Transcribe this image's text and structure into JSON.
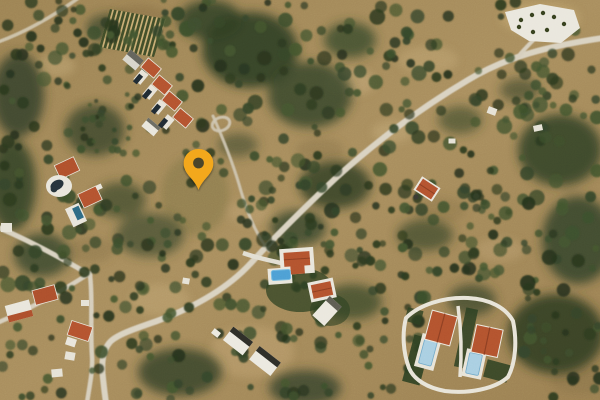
{
  "map": {
    "view": "satellite",
    "marker": {
      "shape": "pin",
      "fill": "#F3A81E",
      "hole": "#4B452C",
      "tip_x": 198,
      "tip_y": 189
    },
    "palette": {
      "terrain": "#A2885A",
      "vegetation": "#35452A",
      "road": "#D9D2C1",
      "roof_red": "#B4532F",
      "roof_white": "#EAE7DE",
      "pool_blue": "#4D9FD4"
    }
  }
}
